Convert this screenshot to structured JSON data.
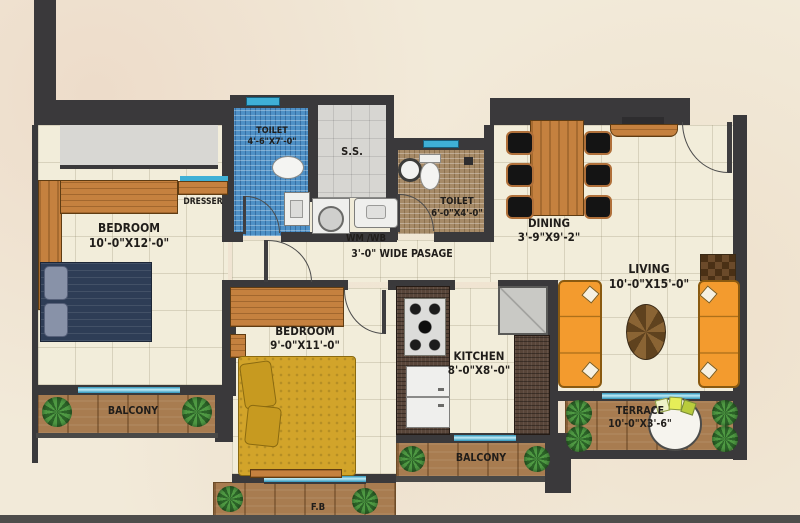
{
  "rooms": {
    "bedroom1": {
      "name": "BEDROOM",
      "dims": "10'-0\"X12'-0\""
    },
    "bedroom2": {
      "name": "BEDROOM",
      "dims": "9'-0\"X11'-0\""
    },
    "toilet1": {
      "name": "TOILET",
      "dims": "4'-6\"X7'-0\""
    },
    "toilet2": {
      "name": "TOILET",
      "dims": "6'-0\"X4'-0\""
    },
    "ss": {
      "name": "S.S."
    },
    "dining": {
      "name": "DINING",
      "dims": "3'-9\"X9'-2\""
    },
    "living": {
      "name": "LIVING",
      "dims": "10'-0\"X15'-0\""
    },
    "kitchen": {
      "name": "KITCHEN",
      "dims": "8'-0\"X8'-0\""
    },
    "terrace": {
      "name": "TERRACE",
      "dims": "10'-0\"X3'-6\""
    },
    "balcony_left": {
      "name": "BALCONY"
    },
    "balcony_bottom": {
      "name": "BALCONY"
    },
    "flower_bed": {
      "name": "F.B"
    }
  },
  "annotations": {
    "dresser": "DRESSER",
    "wm_wb": "WM /WB",
    "passage": "3'-0\" WIDE PASAGE"
  },
  "colors": {
    "wall": "#3a393b",
    "floor": "#f2edda",
    "wood": "#c5813f",
    "deck_wood": "#a87c50",
    "toilet1_tile": "#4e90c6",
    "toilet2_tile": "#a68a67",
    "window": "#41b2d8",
    "sofa": "#f39b2e",
    "bed1": "#2e3d56",
    "bed2": "#d2a42a",
    "plant": "#4f9a43",
    "ss_floor": "#d7d6d2"
  }
}
